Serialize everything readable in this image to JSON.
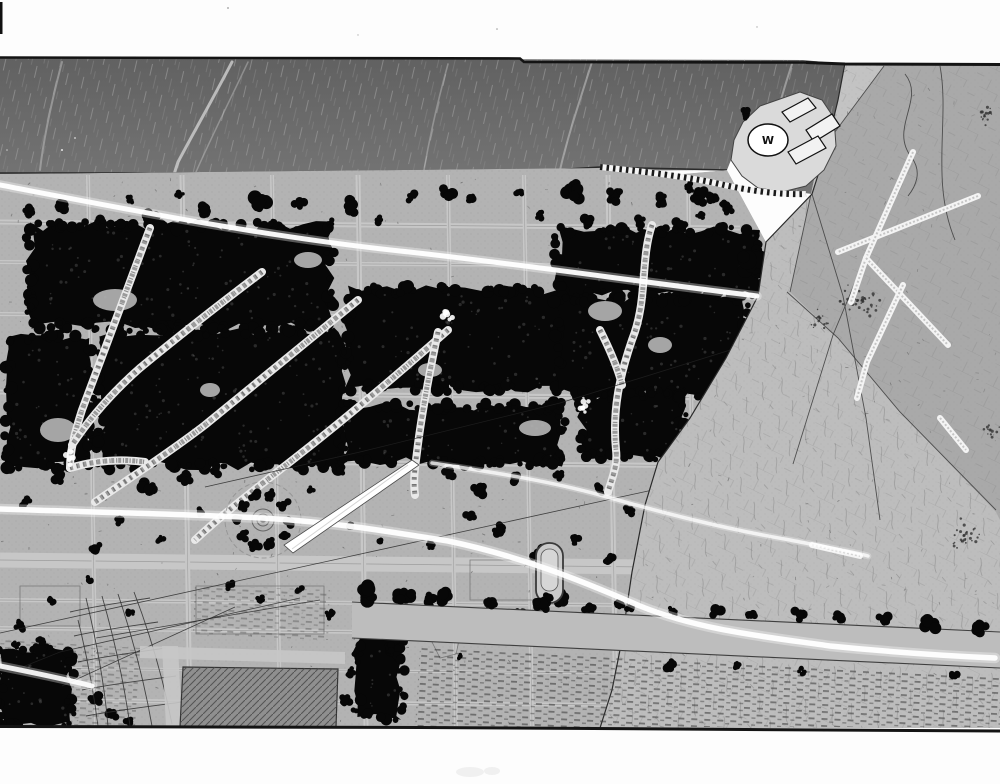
{
  "landmark": {
    "label": "W"
  },
  "palette": {
    "page": "#fdfdfd",
    "waterTop": "#616161",
    "waterBot": "#757575",
    "ink": "#141414",
    "park": "#b3b3b3",
    "street": "#c7c7c7",
    "streetline": "#7a7a7a",
    "forest": "#070707",
    "plain": "#a9a9a9",
    "plainLight": "#bdbdbd",
    "plainWedge": "#c3c3c3",
    "boundary": "#2a2a2a",
    "pond": "#8f8f8f",
    "peninsula": "#dadada",
    "trail": "#e9e9e9",
    "trailDash": "#9a9a9a",
    "streak": "#ffffff",
    "white": "#ffffff"
  },
  "scene": {
    "water": {
      "poly": "0,58 803,60 845,64 838,100 826,150 812,194 790,191 758,188 742,176 731,160 727,170 0,174",
      "topline": "M0,57.5 L520,58.5 L524,62 L806,62.5",
      "shoreline": "M0,173 L300,173 L520,172 L600,167 L727,170",
      "wstreaks": [
        {
          "d": "M232,62 C215,95 195,130 178,162 C172,180 168,195 166,208",
          "w": 3,
          "o": 0.8
        },
        {
          "d": "M248,62 C230,100 210,140 196,172",
          "w": 1.5,
          "o": 0.4
        },
        {
          "d": "M592,62 C580,100 568,135 560,170",
          "w": 2,
          "o": 0.5
        },
        {
          "d": "M62,62 C52,100 44,135 40,170",
          "w": 2,
          "o": 0.45
        },
        {
          "d": "M448,64 C438,100 430,135 424,170",
          "w": 1.6,
          "o": 0.4
        },
        {
          "d": "M792,64 C780,100 770,138 762,168",
          "w": 2,
          "o": 0.5
        }
      ]
    },
    "park": {
      "poly": "0,174 600,168 660,176 727,170 766,242 758,296 726,358 690,418 658,462 645,505 632,572 622,640 612,690 600,728 0,728"
    },
    "plain": {
      "poly": "845,63 1000,64 1000,728 600,728 612,690 622,640 632,572 645,505 658,462 690,418 726,358 758,296 766,242 812,194 826,150 838,100",
      "lightPoly": "820,152 790,292 838,338 900,412 996,512 1000,520 1000,728 600,728 612,690 622,640 632,572 645,505 658,462 690,418 726,358 758,296 766,242 812,194",
      "wedgePoly": "845,64 884,66 820,152 790,292 766,242 812,194 826,150 838,100",
      "topline": "M806,62.5 L845,64 L1000,64.5",
      "boundary": "M845,63 L838,100 L826,150 L812,194 L766,242 L758,296 L726,358 L690,418 L658,462 L645,505 L632,572 L622,640 L612,690 L600,728",
      "lines": [
        "M884,66 L820,152 L790,292",
        "M787,292 L838,338 L900,412 L996,510",
        "M870,247 L833,335 L793,464",
        "M905,74 C926,100 888,128 912,158 C922,172 916,186 908,196",
        "M812,194 L843,296 L866,418 L880,520",
        "M940,66 C950,120 930,180 955,240"
      ],
      "spots": [
        [
          862,
          300,
          22,
          40
        ],
        [
          985,
          115,
          12,
          18
        ],
        [
          965,
          535,
          18,
          28
        ],
        [
          820,
          318,
          12,
          16
        ],
        [
          990,
          430,
          10,
          12
        ]
      ],
      "burst": [
        "M978,196 L838,252",
        "M913,152 L866,258 L851,302",
        "M866,258 L948,345",
        "M903,285 L867,362 L857,398",
        "M940,418 L966,450",
        "M812,545 L860,556"
      ]
    },
    "hstreets": [
      [
        222,
        228,
        5
      ],
      [
        262,
        266,
        4
      ],
      [
        314,
        318,
        4
      ],
      [
        392,
        398,
        5
      ],
      [
        460,
        466,
        5
      ],
      [
        560,
        568,
        15
      ],
      [
        600,
        606,
        4
      ],
      [
        628,
        636,
        4
      ],
      [
        668,
        674,
        3
      ],
      [
        700,
        706,
        4
      ]
    ],
    "vstreets": [
      [
        88,
        4
      ],
      [
        182,
        5
      ],
      [
        272,
        4
      ],
      [
        358,
        5
      ],
      [
        448,
        4
      ],
      [
        524,
        4
      ],
      [
        608,
        5
      ],
      [
        688,
        4
      ]
    ],
    "forest": [
      [
        30,
        226,
        300,
        100
      ],
      [
        8,
        338,
        82,
        128
      ],
      [
        100,
        332,
        242,
        134
      ],
      [
        348,
        290,
        232,
        98
      ],
      [
        344,
        406,
        218,
        56
      ],
      [
        558,
        230,
        200,
        64
      ],
      [
        558,
        298,
        188,
        96
      ],
      [
        582,
        396,
        100,
        60
      ],
      [
        915,
        638,
        85,
        66
      ],
      [
        0,
        650,
        70,
        74
      ],
      [
        357,
        625,
        44,
        92
      ]
    ],
    "clumps": [
      [
        60,
        205,
        10
      ],
      [
        30,
        210,
        7
      ],
      [
        100,
        222,
        8
      ],
      [
        150,
        218,
        9
      ],
      [
        205,
        210,
        8
      ],
      [
        258,
        204,
        12
      ],
      [
        300,
        202,
        8
      ],
      [
        352,
        206,
        10
      ],
      [
        410,
        196,
        7
      ],
      [
        447,
        192,
        9
      ],
      [
        470,
        198,
        7
      ],
      [
        520,
        194,
        6
      ],
      [
        575,
        192,
        12
      ],
      [
        615,
        196,
        9
      ],
      [
        660,
        200,
        8
      ],
      [
        700,
        196,
        10
      ],
      [
        725,
        205,
        7
      ],
      [
        588,
        222,
        9
      ],
      [
        640,
        222,
        7
      ],
      [
        680,
        225,
        8
      ],
      [
        540,
        215,
        6
      ],
      [
        380,
        220,
        6
      ],
      [
        330,
        222,
        5
      ],
      [
        275,
        225,
        6
      ],
      [
        225,
        228,
        5
      ],
      [
        130,
        200,
        5
      ],
      [
        180,
        195,
        5
      ],
      [
        690,
        188,
        6
      ],
      [
        712,
        196,
        7
      ],
      [
        728,
        210,
        6
      ],
      [
        700,
        215,
        5
      ],
      [
        752,
        262,
        16
      ],
      [
        766,
        270,
        10
      ],
      [
        148,
        488,
        10
      ],
      [
        185,
        478,
        8
      ],
      [
        216,
        470,
        7
      ],
      [
        60,
        478,
        8
      ],
      [
        25,
        502,
        7
      ],
      [
        95,
        548,
        8
      ],
      [
        120,
        520,
        6
      ],
      [
        160,
        540,
        5
      ],
      [
        200,
        512,
        6
      ],
      [
        310,
        490,
        5
      ],
      [
        340,
        470,
        6
      ],
      [
        450,
        475,
        8
      ],
      [
        480,
        490,
        10
      ],
      [
        515,
        480,
        7
      ],
      [
        560,
        475,
        6
      ],
      [
        600,
        490,
        7
      ],
      [
        630,
        510,
        6
      ],
      [
        470,
        515,
        7
      ],
      [
        500,
        530,
        8
      ],
      [
        540,
        555,
        9
      ],
      [
        575,
        540,
        6
      ],
      [
        610,
        560,
        7
      ],
      [
        430,
        545,
        6
      ],
      [
        380,
        540,
        5
      ],
      [
        350,
        525,
        5
      ],
      [
        230,
        585,
        6
      ],
      [
        260,
        600,
        5
      ],
      [
        300,
        590,
        5
      ],
      [
        330,
        615,
        6
      ],
      [
        90,
        580,
        5
      ],
      [
        50,
        600,
        6
      ],
      [
        20,
        625,
        7
      ],
      [
        130,
        612,
        5
      ],
      [
        430,
        600,
        8
      ],
      [
        460,
        615,
        6
      ],
      [
        490,
        605,
        5
      ],
      [
        520,
        612,
        6
      ],
      [
        560,
        600,
        10
      ],
      [
        590,
        615,
        7
      ],
      [
        620,
        605,
        6
      ],
      [
        650,
        612,
        5
      ],
      [
        95,
        700,
        8
      ],
      [
        112,
        714,
        7
      ],
      [
        130,
        722,
        6
      ],
      [
        40,
        640,
        6
      ],
      [
        15,
        645,
        5
      ],
      [
        345,
        700,
        7
      ],
      [
        350,
        672,
        6
      ],
      [
        900,
        660,
        10
      ],
      [
        940,
        700,
        9
      ],
      [
        970,
        640,
        8
      ],
      [
        746,
        116,
        6
      ]
    ],
    "clearings": [
      [
        115,
        300,
        22,
        11
      ],
      [
        58,
        430,
        18,
        12
      ],
      [
        605,
        311,
        17,
        10
      ],
      [
        535,
        428,
        16,
        8
      ],
      [
        660,
        345,
        12,
        8
      ],
      [
        210,
        390,
        10,
        7
      ],
      [
        430,
        370,
        12,
        7
      ],
      [
        308,
        260,
        14,
        8
      ]
    ],
    "trails": [
      "M150,228 C130,280 105,350 82,410 C75,432 70,450 70,468",
      "M70,468 C90,462 115,458 145,462",
      "M262,272 C225,300 180,335 140,368 C115,390 92,415 72,445",
      "M358,300 C315,335 260,380 205,425 C170,452 130,478 95,502",
      "M448,330 C405,368 350,415 295,458 C258,487 225,512 195,540",
      "M438,332 C430,370 422,410 417,452 C415,468 413,480 415,495",
      "M652,225 C640,260 648,300 632,340 C620,375 612,410 616,450 C618,465 612,478 608,492",
      "M600,330 C610,350 618,368 622,385"
    ],
    "splats": [
      [
        585,
        408,
        9
      ],
      [
        70,
        458,
        7
      ],
      [
        448,
        316,
        6
      ]
    ],
    "cables": [
      "M788,332 L560,403 L360,452 L205,487",
      "M680,484 L347,557 L0,633",
      "M300,598 L60,652 L20,668",
      "M320,600 L96,638",
      "M235,607 L62,686"
    ],
    "mesh": [
      "M86,598 C96,640 104,680 108,726",
      "M102,596 C114,638 124,682 130,726",
      "M118,594 C132,636 144,680 152,726",
      "M134,592 C150,634 163,678 172,724",
      "M78,620 C88,660 94,695 98,726",
      "M70,612 C95,606 125,602 150,598",
      "M74,636 C100,630 132,626 158,622",
      "M78,662 C106,656 138,652 166,648",
      "M82,690 C112,684 146,680 176,676",
      "M86,716 C118,710 152,706 182,702"
    ],
    "pond": {
      "poly": "183,667 338,669 336,727 180,727",
      "roadAbove": "140,646 345,652 345,664 140,658",
      "roadLeft": "162,646 178,646 182,727 166,727"
    },
    "circlePlaza": {
      "cx": 263,
      "cy": 520,
      "rOuter": 38,
      "rRing": 26,
      "rings": [
        11,
        6,
        2.5
      ]
    },
    "ringPool": {
      "x": 536,
      "y": 543,
      "w": 27,
      "h": 60,
      "rx": 13
    },
    "cityShapes": [
      "M446,628 L460,636 L456,654 L440,658 L432,642 Z",
      "M196,586 h128 v48 h-128 Z",
      "M20,586 h60 v40 h-60 Z",
      "M470,560 h90 v40 h-90 Z"
    ],
    "avenue": {
      "top": [
        352,
        602,
        1000,
        632
      ],
      "bot": [
        352,
        638,
        1000,
        668
      ]
    },
    "pavement": "420,648 1000,678 1000,727 415,727",
    "hatchBlocks": [
      "0,640 140,648 135,726 0,726",
      "195,585 330,590 328,640 193,636"
    ],
    "streaks": [
      {
        "d": "M0,185 C120,208 260,236 400,251 C520,264 640,282 757,296",
        "w": 5,
        "o": 0.95
      },
      {
        "d": "M0,509 C90,512 180,514 262,518 C330,522 380,530 448,541 C520,556 580,580 640,606 C700,630 760,636 830,646 C890,652 950,656 995,658",
        "w": 5.5,
        "o": 0.95
      },
      {
        "d": "M432,463 C490,472 545,480 600,495 C660,512 720,528 790,540 C830,548 855,552 868,556",
        "w": 3.5,
        "o": 0.75
      },
      {
        "d": "M0,666 C30,672 60,678 92,686",
        "w": 5,
        "o": 0.9
      }
    ],
    "contrail": {
      "poly": "412,460 419,465 293,553 284,545",
      "line": "M408,465 L292,549"
    },
    "wall": "M600,167 C648,172 690,177 724,185 C752,191 780,195 806,194",
    "peninsula": {
      "poly": "800,92 822,100 834,118 836,146 824,170 806,186 782,192 758,188 742,176 731,160 734,140 743,122 760,106",
      "buildings": [
        "782,112 808,98 816,108 790,122",
        "806,130 832,114 840,126 814,142",
        "788,152 818,136 826,148 796,164"
      ],
      "oval": {
        "cx": 768,
        "cy": 140,
        "rx": 20,
        "ry": 16
      }
    },
    "borders": {
      "bottom": "M0,726.5 L420,727.5 L1000,731"
    },
    "specks": [
      [
        228,
        8,
        0.9,
        "#9a9a9a"
      ],
      [
        497,
        29,
        0.8,
        "#9a9a9a"
      ],
      [
        757,
        27,
        0.7,
        "#aaaaaa"
      ],
      [
        62,
        150,
        1,
        "#e8e8e8"
      ],
      [
        75,
        138,
        0.9,
        "#dddddd"
      ],
      [
        7,
        150,
        0.8,
        "#cccccc"
      ],
      [
        358,
        35,
        0.7,
        "#b5b5b5"
      ]
    ],
    "edgeMark": [
      0,
      2,
      2.5,
      32
    ],
    "smudges": [
      [
        470,
        772,
        14,
        5
      ],
      [
        492,
        771,
        8,
        4
      ]
    ]
  }
}
